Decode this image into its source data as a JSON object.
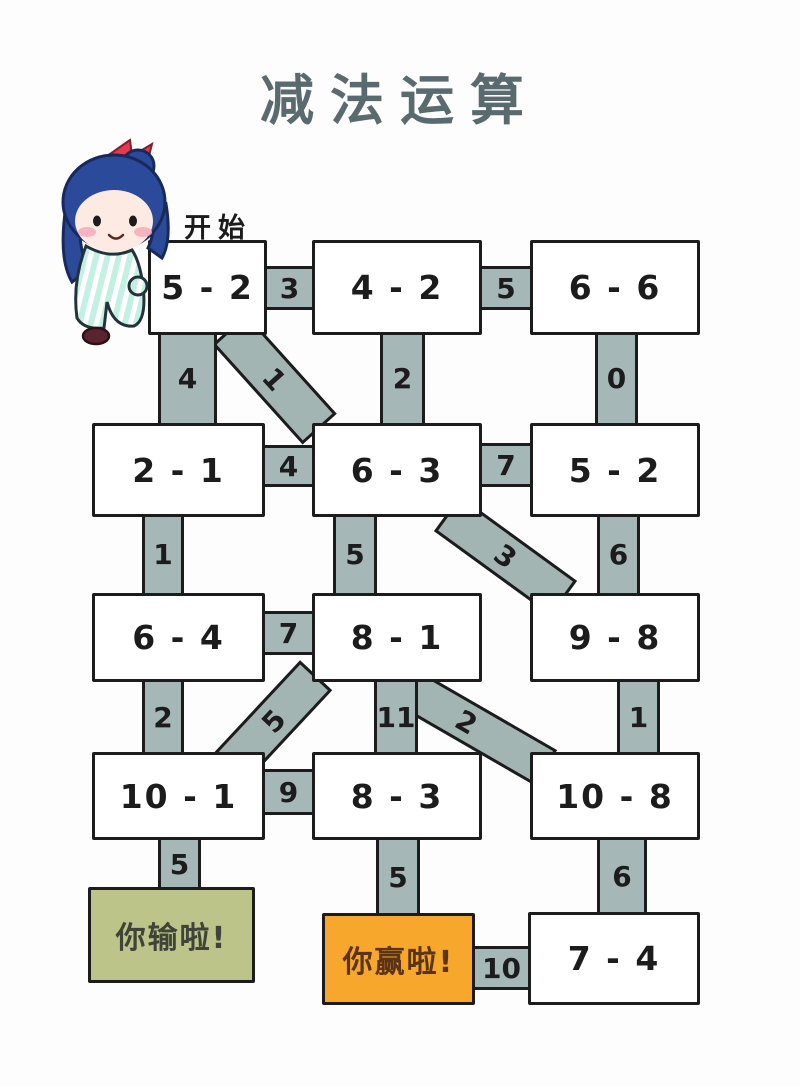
{
  "title": "减法运算",
  "start_label": "开始",
  "cells": [
    "5 - 2",
    "4 - 2",
    "6 - 6",
    "2 - 1",
    "6 - 3",
    "5 - 2",
    "6 - 4",
    "8 - 1",
    "9 - 8",
    "10 - 1",
    "8 - 3",
    "10 - 8",
    "7 - 4"
  ],
  "edges": {
    "h_5_2_to_4_2": "3",
    "h_4_2_to_6_6": "5",
    "v_5_2_to_2_1": "4",
    "d_5_2_to_6_3": "1",
    "v_4_2_to_6_3": "2",
    "v_6_6_to_5_2": "0",
    "h_2_1_to_6_3": "4",
    "h_6_3_to_5_2": "7",
    "v_2_1_to_6_4": "1",
    "v_6_3_to_8_1": "5",
    "d_6_3_to_9_8": "3",
    "v_5_2_to_9_8": "6",
    "h_6_4_to_8_1": "7",
    "v_6_4_to_10_1": "2",
    "d_8_1_to_10_1": "5",
    "v_8_1_to_8_3": "11",
    "d_8_1_to_10_8": "2",
    "v_9_8_to_10_8": "1",
    "h_10_1_to_8_3": "9",
    "v_10_1_to_lose": "5",
    "v_8_3_to_win": "5",
    "v_10_8_to_7_4": "6",
    "h_win_to_7_4": "10"
  },
  "results": {
    "lose": "你输啦!",
    "win": "你赢啦!"
  },
  "colors": {
    "connector_fill": "#a6b7b8",
    "diag_fill": "#a3b5b2",
    "line_color": "#1c1c1c",
    "title_color": "#5a6b70",
    "lose_bg": "#bcc489",
    "lose_text": "#3f4338",
    "win_bg": "#f6a72c",
    "win_text": "#5a3414",
    "box_bg": "#ffffff",
    "page_bg": "#fdfdfd"
  }
}
